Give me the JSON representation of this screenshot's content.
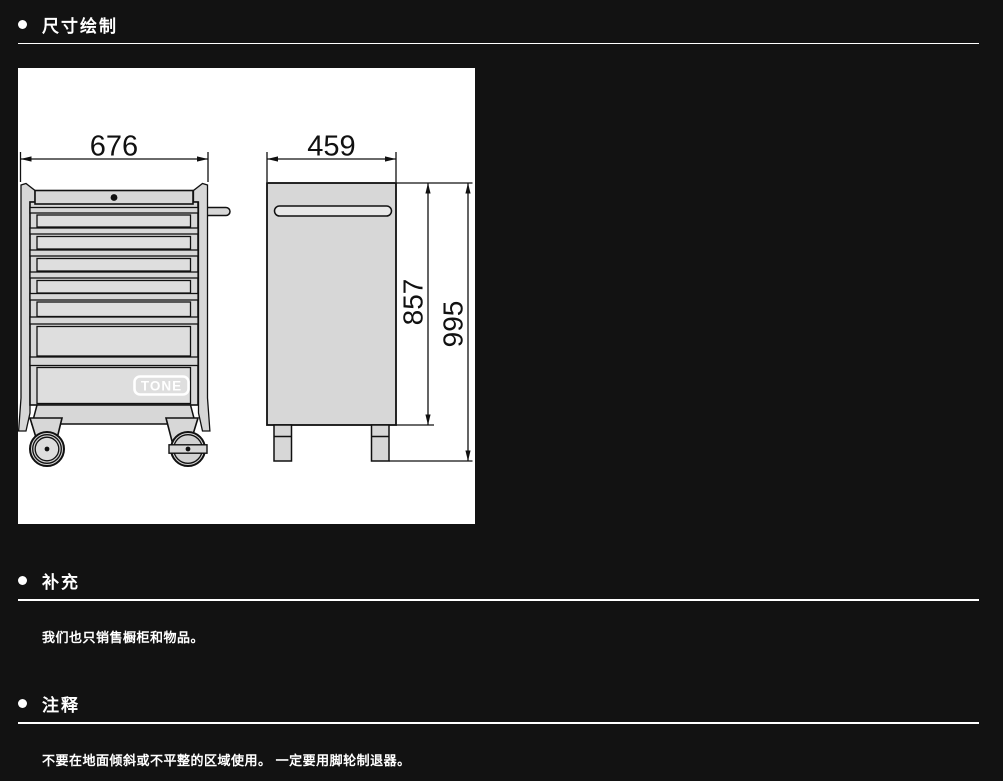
{
  "page": {
    "background_color": "#121212",
    "text_color": "#ffffff",
    "rule_color": "#ffffff"
  },
  "sections": {
    "dimensions": {
      "title": "尺寸绘制"
    },
    "supplement": {
      "title": "补充",
      "body": "我们也只销售橱柜和物品。"
    },
    "notes": {
      "title": "注释",
      "body": "不要在地面倾斜或不平整的区域使用。 一定要用脚轮制退器。"
    }
  },
  "drawing": {
    "kind": "technical dimension drawing of a roller tool cabinet, front view and side view",
    "paper_color": "#ffffff",
    "line_color": "#111111",
    "cabinet_fill": "#d7d7d7",
    "brand_logo": "TONE",
    "labels": {
      "width": "676",
      "depth": "459",
      "body_height": "857",
      "overall_height": "995"
    }
  }
}
